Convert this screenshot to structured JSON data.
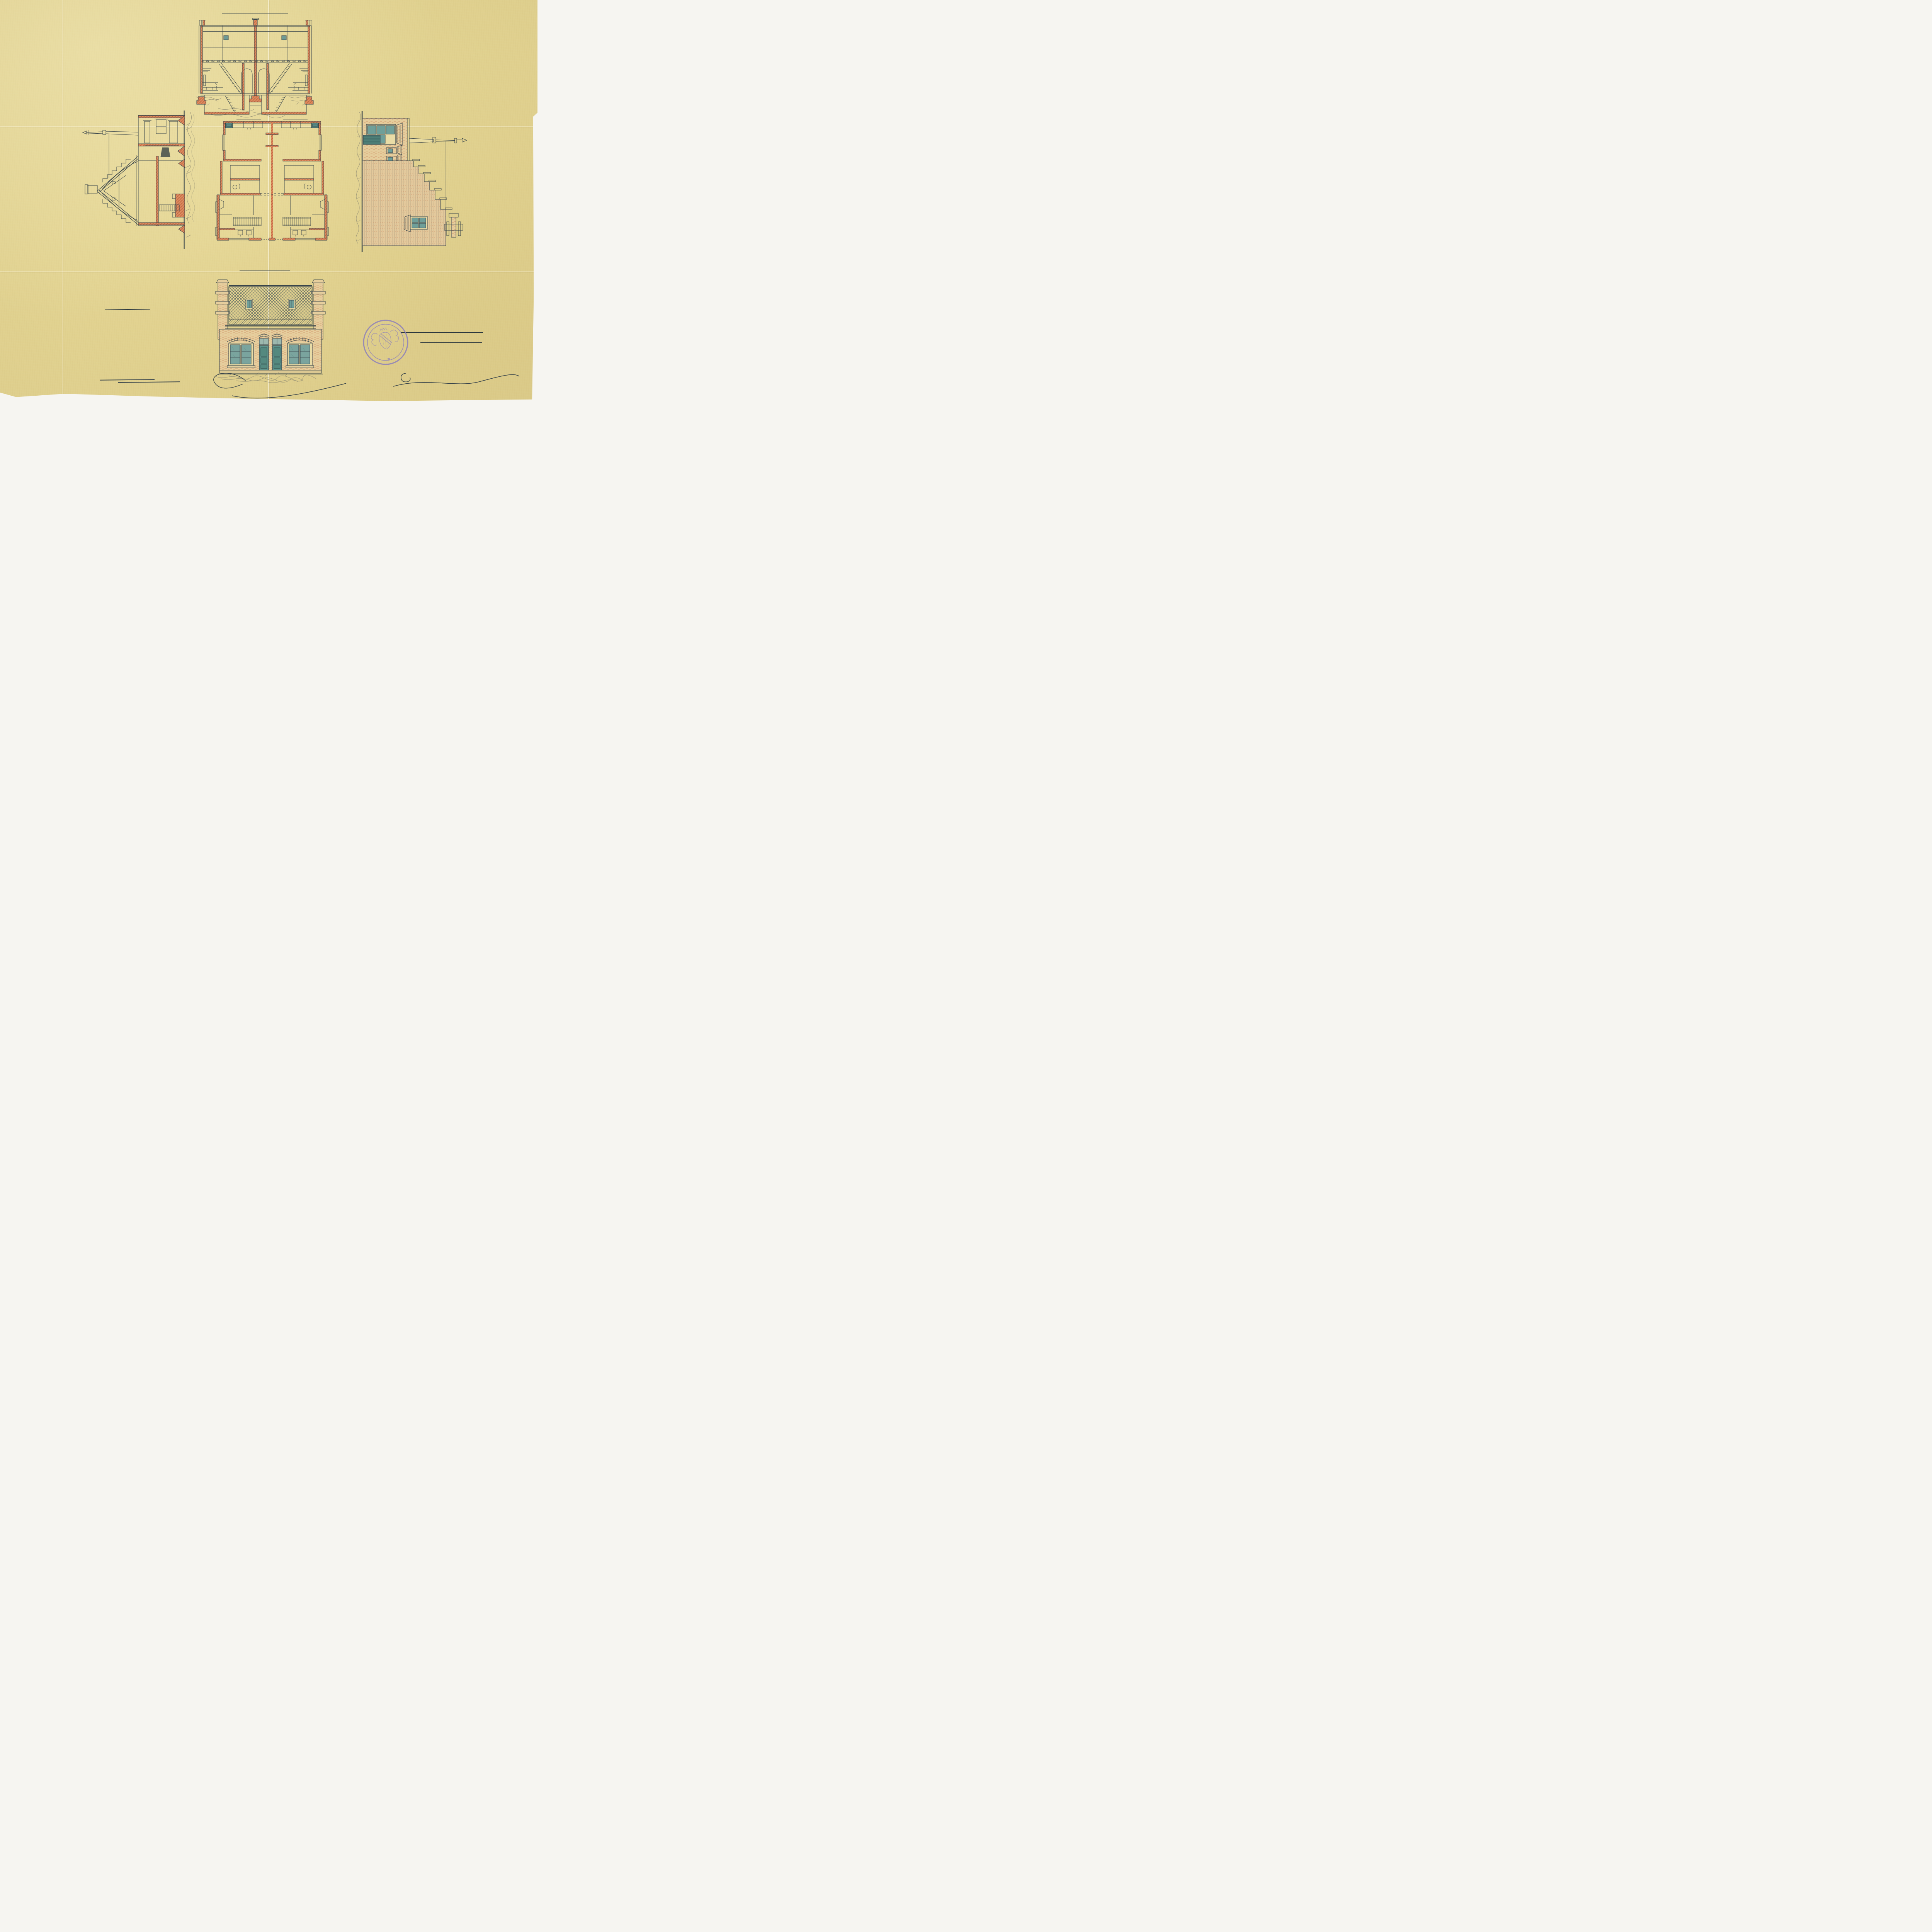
{
  "colors": {
    "paper": "#e8d996",
    "ink": "#39454b",
    "red_chalk": "#cf7148",
    "teal_glass": "#6f9f99",
    "pencil": "#7d7763",
    "stamp_purple": "#8d80bb"
  },
  "titles": {
    "longitudinal_section": "Lengte Doorsnede.",
    "cross_section": "Dwars=Doorsnede.",
    "side_elevation": "Zij Aanzicht",
    "front_facade": "Voor gevel."
  },
  "legend": {
    "heading": "Renvooi.",
    "items_left": [
      {
        "key": "a.",
        "label": "Voorkamertjes."
      },
      {
        "key": "b.",
        "label": "Woonkamers"
      },
      {
        "key": "c.",
        "label": "Keukens."
      },
      {
        "key": "d.",
        "label": "Portalen"
      },
      {
        "key": "e.",
        "label": "Gangen"
      },
      {
        "key": "f.",
        "label": "Bedsteden waaronder Keldertjes."
      },
      {
        "key": "g.",
        "label": "Diverse kasten."
      }
    ],
    "items_right": [
      {
        "key": "h.",
        "label": "Trappen naar de Zolders."
      },
      {
        "key": "i.",
        "label": "Bergplaatsen voor Brandstoffen enz."
      },
      {
        "key": "j.",
        "label": "Privaten"
      },
      {
        "key": "k.",
        "label": "Gootsteenen met waterleiding."
      },
      {
        "key": "l.",
        "label": "aanrechtbanken waaronder kastjes of bakken voor turf, hout, etc."
      }
    ]
  },
  "title_block": {
    "heading": "Plan",
    "line1": "voor twee Arbeiderswoningen",
    "line2": "op een terrein Gemᵗᵉ Dordrecht.",
    "line3": "Kad: Sectie D N°= als op bijgaand uittreksel",
    "scale": "Schaal van 1 à 100.",
    "pencil": "Behoort bij Kennisgeving",
    "number": "N°. 40/1892"
  },
  "annotations": {
    "probably1": "Waarschijnlijk",
    "probably2": "niet doorgegaan",
    "probably3": "of afgebroken",
    "street": "Geldelozepad.",
    "street_numbers": "29-30",
    "mark": "2-0",
    "archive1": "4/11 2/0",
    "archive2": "1885",
    "offset": "548/obs/10",
    "stray": "op"
  },
  "stamp": {
    "text": "SIGILLUM CIVITATIS DORDRACENAE."
  },
  "signature": {
    "name": "J. Roobol Hzn."
  },
  "plan": {
    "labels": [
      "k",
      "l.",
      "g.",
      "g.",
      "l.",
      "k",
      "c.",
      "c.",
      "i.",
      "i.",
      "d.",
      "d.",
      "j.",
      "j.",
      "b.",
      "b.",
      "f.",
      "h",
      "e.",
      "e",
      "h",
      "f.",
      "g.",
      "g.",
      "g.",
      "g.",
      "a.",
      "a."
    ]
  }
}
